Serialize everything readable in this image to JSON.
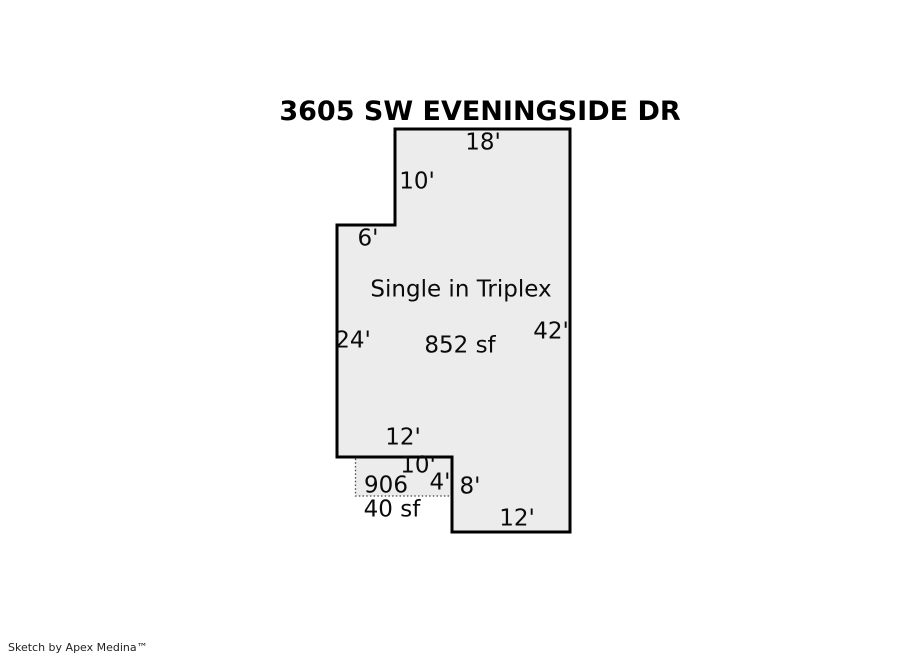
{
  "page": {
    "title": "3605 SW EVENINGSIDE DR",
    "credit": "Sketch by Apex Medina™"
  },
  "plan": {
    "fill_color": "#ececec",
    "outline_color": "#000000",
    "porch_outline_color": "#444444",
    "unit_name": "Single in Triplex",
    "main_area": "852 sf",
    "porch_number": "906",
    "porch_area": "40 sf",
    "dimensions": {
      "top": "18'",
      "upper_left": "10'",
      "step": "6'",
      "left": "24'",
      "right": "42'",
      "bottom_main": "12'",
      "porch_top": "10'",
      "porch_right": "4'",
      "lower_right": "8'",
      "bottom": "12'"
    }
  }
}
